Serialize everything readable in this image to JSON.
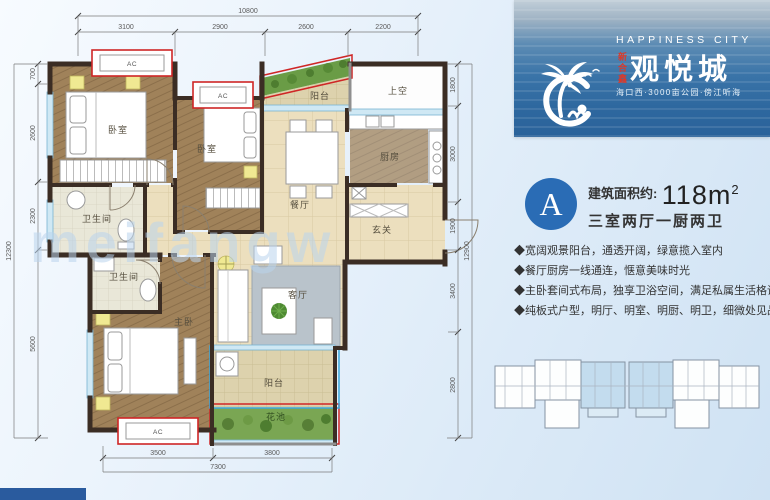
{
  "brand": {
    "english": "HAPPINESS CITY",
    "name": "观悦城",
    "tag": "新合鑫",
    "tagline": "海口西·3000亩公园·傍江听海"
  },
  "unit": {
    "badge": "A",
    "area_label": "建筑面积约:",
    "area_value": "118m",
    "area_sup": "2",
    "rooms_line": "三室两厅一厨两卫",
    "features": [
      "◆宽阔观景阳台，通透开阔，绿意揽入室内",
      "◆餐厅厨房一线通连，惬意美味时光",
      "◆主卧套间式布局，独享卫浴空间，满足私属生活格调",
      "◆纯板式户型，明厅、明室、明厨、明卫，细微处见品质"
    ]
  },
  "plan": {
    "watermark": "meifangw",
    "labels": {
      "bedroom1": "卧室",
      "bedroom2": "卧室",
      "balcony_top": "阳台",
      "void": "上空",
      "kitchen": "厨房",
      "dining": "餐厅",
      "foyer": "玄关",
      "bath1": "卫生间",
      "bath2": "卫生间",
      "master": "主卧",
      "living": "客厅",
      "balcony_bottom": "阳台",
      "flowerbed": "花池",
      "ac": "AC"
    },
    "dims": {
      "top_total": "10800",
      "top": [
        "3100",
        "2900",
        "2600",
        "2200"
      ],
      "left_total": "12300",
      "left": [
        "700",
        "2600",
        "2300",
        "5600"
      ],
      "right_total": "12900",
      "right": [
        "1800",
        "3000",
        "1900",
        "3400",
        "2800"
      ],
      "bottom": [
        "3500",
        "3800"
      ],
      "bottom_total": "7300"
    }
  },
  "colors": {
    "brand_blue": "#2e689f",
    "badge_blue": "#2a6cb5",
    "accent_red": "#cf2626",
    "highlight_unit": "#c3dcee"
  }
}
